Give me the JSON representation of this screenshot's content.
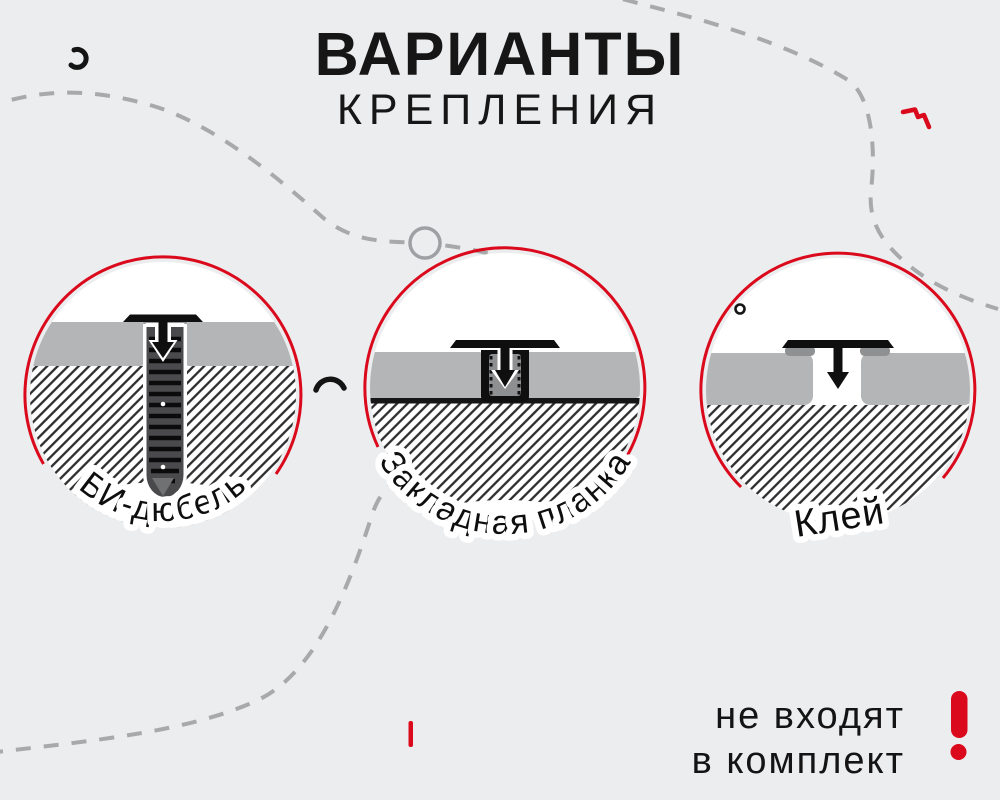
{
  "title": {
    "line1": "ВАРИАНТЫ",
    "line2": "КРЕПЛЕНИЯ"
  },
  "variants": [
    {
      "id": "bi-dowel",
      "label": "БИ-дюбель"
    },
    {
      "id": "embedded-plank",
      "label": "Закладная планка"
    },
    {
      "id": "glue",
      "label": "Клей"
    }
  ],
  "note": {
    "line1": "не входят",
    "line2": "в комплект",
    "exclamation_icon": "!"
  },
  "colors": {
    "bg": "#ecedef",
    "red": "#da0a1c",
    "panel": "#b3b5b7",
    "dash": "#a7a9ab",
    "ink": "#141414"
  }
}
